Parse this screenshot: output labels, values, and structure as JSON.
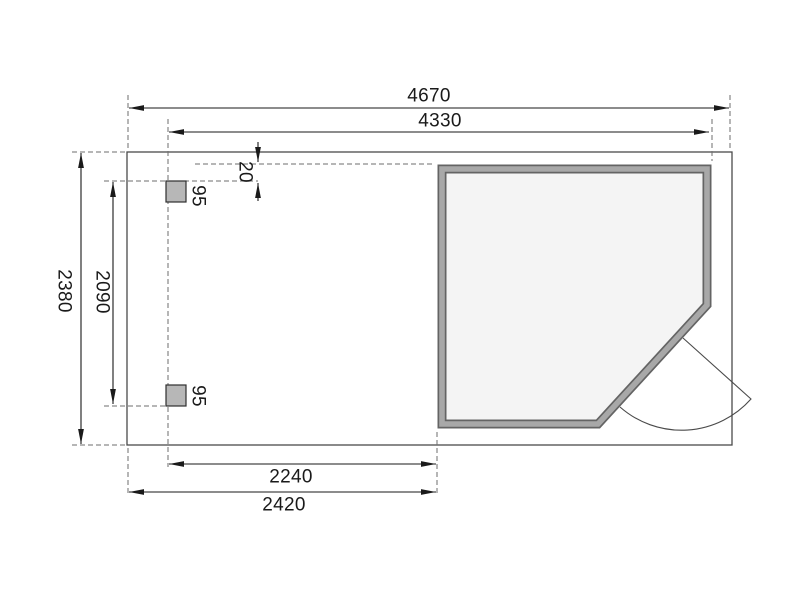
{
  "dims": {
    "width_total": "4670",
    "width_inner": "4330",
    "offset_top": "20",
    "depth_total": "2380",
    "post_spacing": "2090",
    "post_top_size": "95",
    "post_bottom_size": "95",
    "annex_inner_width": "2240",
    "annex_outer_width": "2420"
  },
  "colors": {
    "wall_band": "#a8a8a8",
    "wall_edge": "#646464",
    "cabin_interior": "#f4f4f4",
    "post_fill": "#b7b7b7",
    "dimension_line": "#1a1a1a",
    "extension_dash": "#6e6e6e",
    "outline": "#4a4a4a"
  }
}
